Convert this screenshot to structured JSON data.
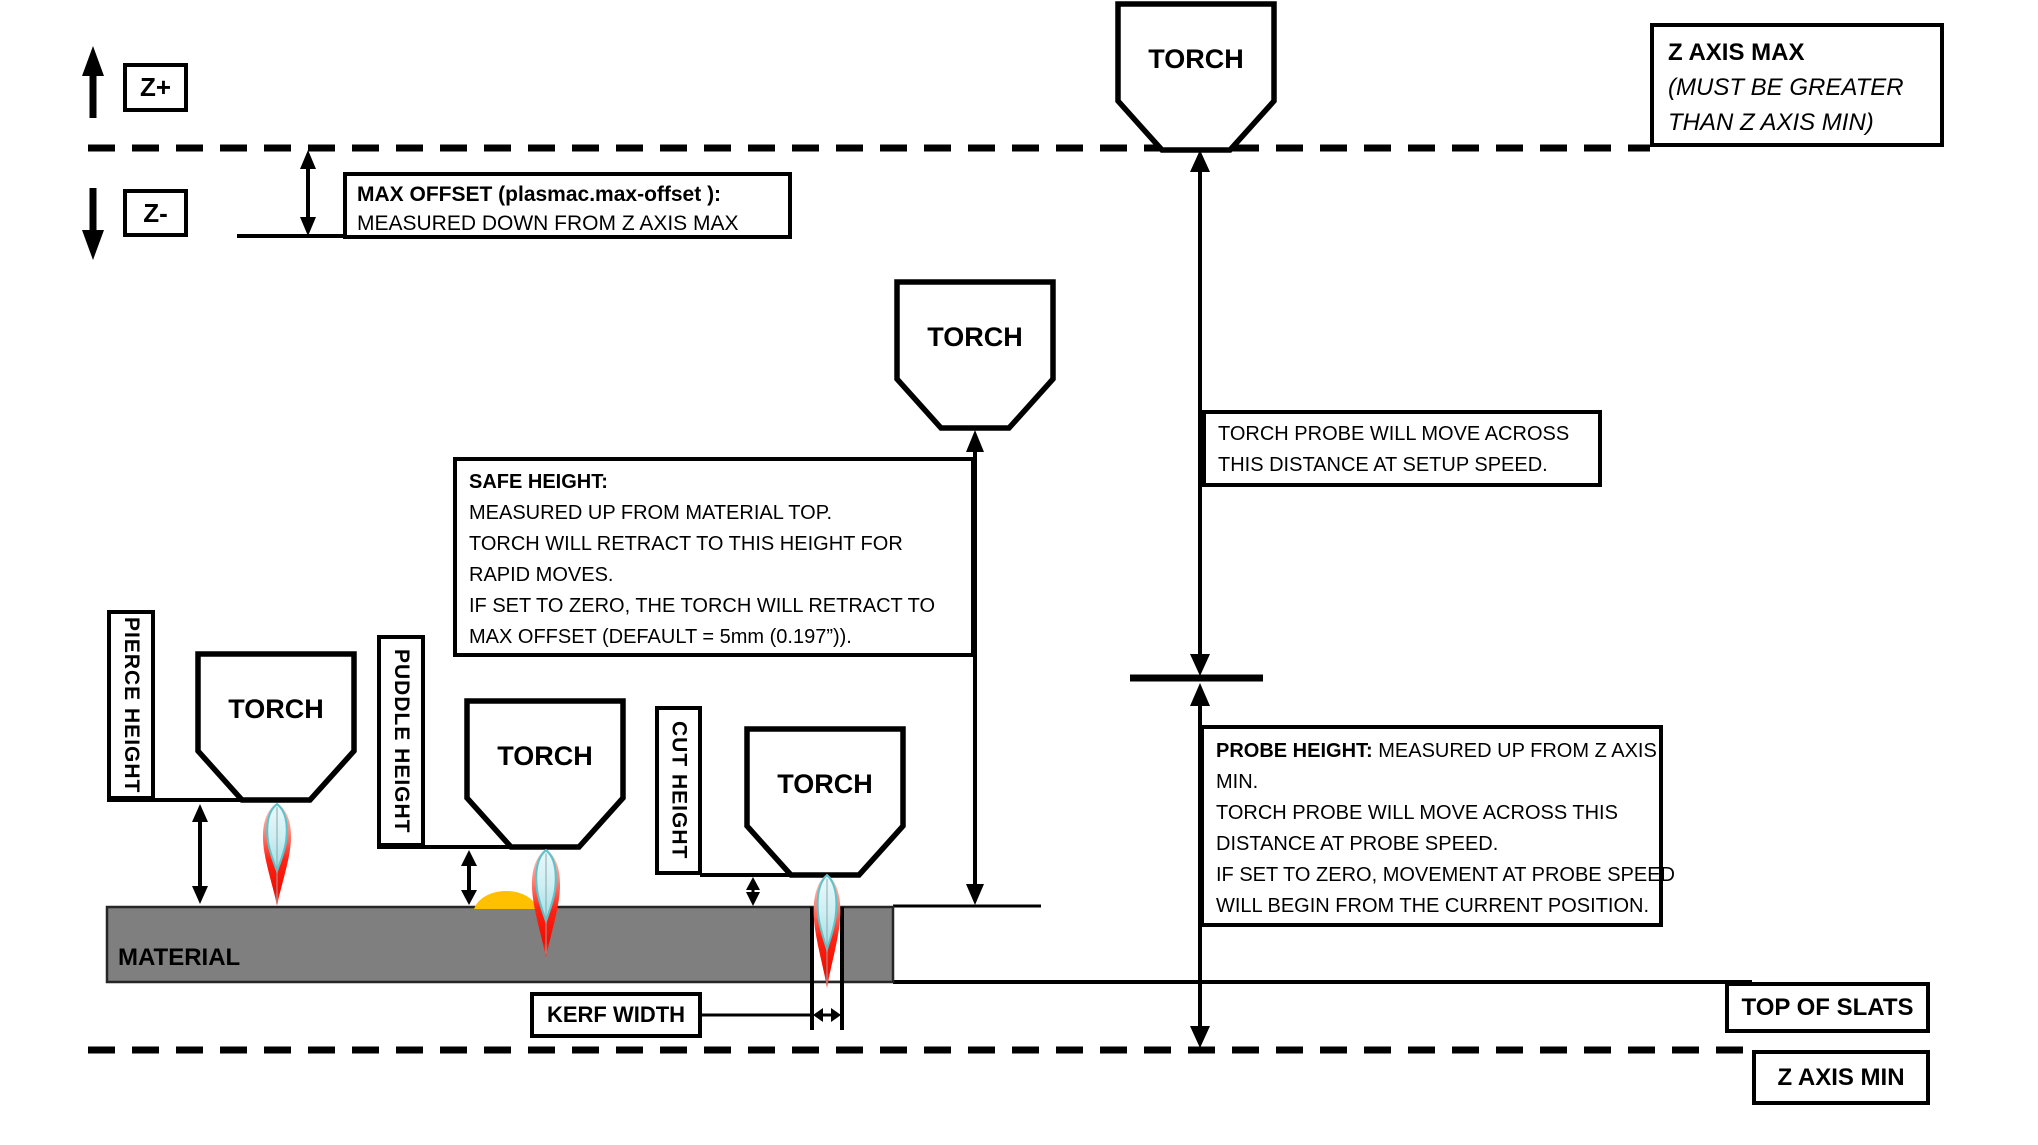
{
  "axis": {
    "z_plus": "Z+",
    "z_minus": "Z-",
    "z_axis_max": {
      "title": "Z AXIS MAX",
      "note_line1": "(MUST BE GREATER",
      "note_line2": "THAN Z AXIS MIN)"
    },
    "z_axis_min": "Z AXIS MIN",
    "top_of_slats": "TOP OF SLATS"
  },
  "torch": {
    "label": "TORCH"
  },
  "max_offset": {
    "line1": "MAX OFFSET (plasmac.max-offset ):",
    "line2": "MEASURED DOWN FROM Z AXIS MAX"
  },
  "safe_height": {
    "title": "SAFE HEIGHT:",
    "lines": [
      "MEASURED UP FROM MATERIAL TOP.",
      "TORCH WILL RETRACT TO THIS HEIGHT FOR",
      "RAPID MOVES.",
      "IF SET TO ZERO, THE TORCH WILL RETRACT TO",
      "MAX OFFSET (DEFAULT = 5mm (0.197”))."
    ]
  },
  "torch_probe": {
    "line1": "TORCH PROBE WILL MOVE ACROSS",
    "line2": "THIS DISTANCE AT SETUP SPEED."
  },
  "probe_height": {
    "title": "PROBE HEIGHT:",
    "title_rest": " MEASURED UP FROM Z AXIS",
    "lines": [
      "MIN.",
      "TORCH PROBE WILL MOVE ACROSS THIS",
      "DISTANCE AT PROBE SPEED.",
      "IF SET TO ZERO,  MOVEMENT AT PROBE SPEED",
      "WILL BEGIN FROM THE CURRENT POSITION."
    ]
  },
  "height_labels": {
    "pierce": "PIERCE HEIGHT",
    "puddle": "PUDDLE HEIGHT",
    "cut": "CUT HEIGHT"
  },
  "material": {
    "label": "MATERIAL",
    "color": "#7F7F7F"
  },
  "kerf": {
    "label": "KERF WIDTH"
  },
  "colors": {
    "line_black": "#000000",
    "flame_red": "#FF2012",
    "flame_inner_blue": "#CEEFF3",
    "flame_inner_edge": "#5BC4CB",
    "puddle_orange": "#FFC000"
  }
}
